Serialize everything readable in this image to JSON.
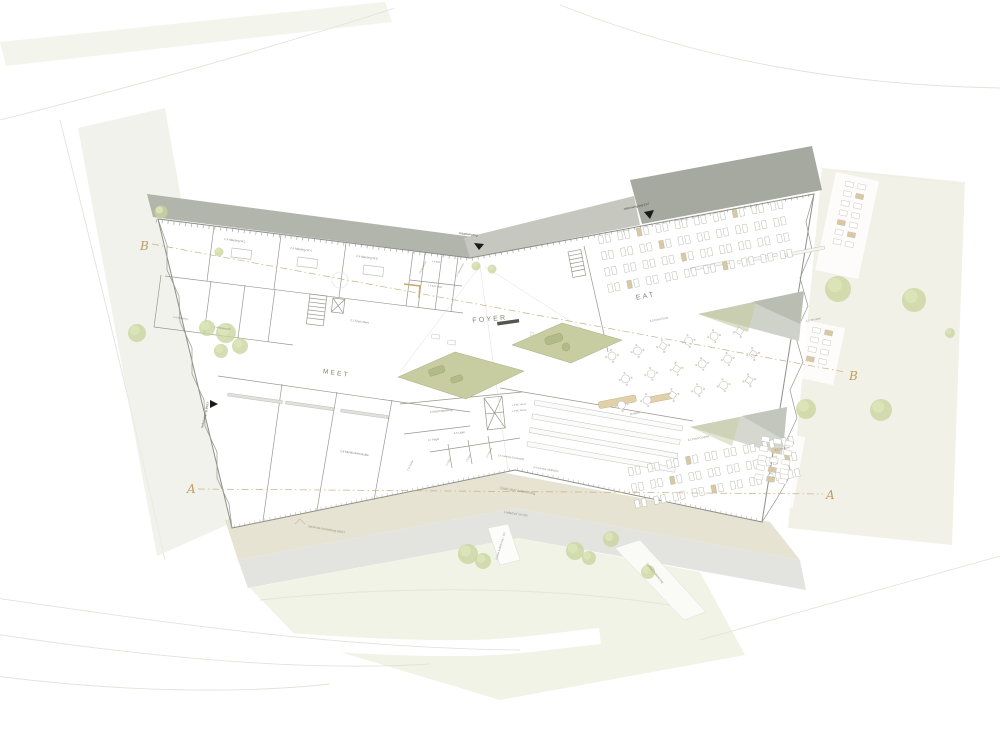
{
  "drawing": {
    "zones": {
      "foyer": "FOYER",
      "eat": "EAT",
      "meet": "MEET"
    },
    "entrances": {
      "main": "Haupteingang",
      "side_eat": "Nebeneingang EAT",
      "side_meet": "Nebeneingang MEET"
    },
    "rooms_meet_wing": {
      "w1": "2.4 Meeting W.1",
      "w4": "2.4 Meeting W.4",
      "w6": "2.4 Meeting W.6",
      "garderobe": "1.3 Garderobe",
      "bmz": "1.4 BMZ",
      "buero_lager": "1.5 Büro Lager",
      "server": "1.2 Serverraum",
      "meeting_l": "2.4 Meeting L",
      "meeting_m": "2.4 Meeting M",
      "halls": "2.8 Multifunktionssäle",
      "foyer_meet": "2.1 Foyer Meet"
    },
    "rooms_center": {
      "buchhandlung": "2.9 Buchhandlung",
      "regal": "2.7 Regal",
      "lager": "2.6 Lager",
      "sanitaer": "2.10 Sanitär",
      "buero2": "2.2 Büro",
      "buero3": "2.3 Büro",
      "service": "1.1 Service",
      "wc_h": "1.4 WC Herren",
      "wc_d": "1.5 WC Damen",
      "catering": "2.6 Catering Schnittstelle",
      "kueche": "3.4 Sonnen-Südküche"
    },
    "rooms_eat_wing": {
      "food_court": "2.5 Food Court",
      "food_counter": "2.1 Food Counter",
      "ausgabe": "Ausgabe",
      "terrasse_upper": "2.5 Terrasse",
      "terrasse_lower": "2.5 Terrasse"
    },
    "site": {
      "dach_anlieferung": "Dach über Anlieferung",
      "lieferhof": "Lieferhof im UG",
      "zufahrt_ug": "Zufahrt Anlieferung i. UG",
      "zufahrt": "Zufahrt Anlieferung",
      "ausstellung": "optionale Ausstellung MEET"
    },
    "sections": {
      "a_left": "A",
      "a_right": "A",
      "b_left": "B",
      "b_right": "B"
    },
    "colors": {
      "roof_dark": "#a6a99f",
      "roof_mid": "#b2b5ac",
      "roof_light": "#c6c8c0",
      "courtyard_green": "#c7cda1",
      "tree_green": "#c9d49e",
      "section_tan": "#bf9c63",
      "accent_tan": "#d9c8a2",
      "wall_gray": "#97988f"
    }
  }
}
